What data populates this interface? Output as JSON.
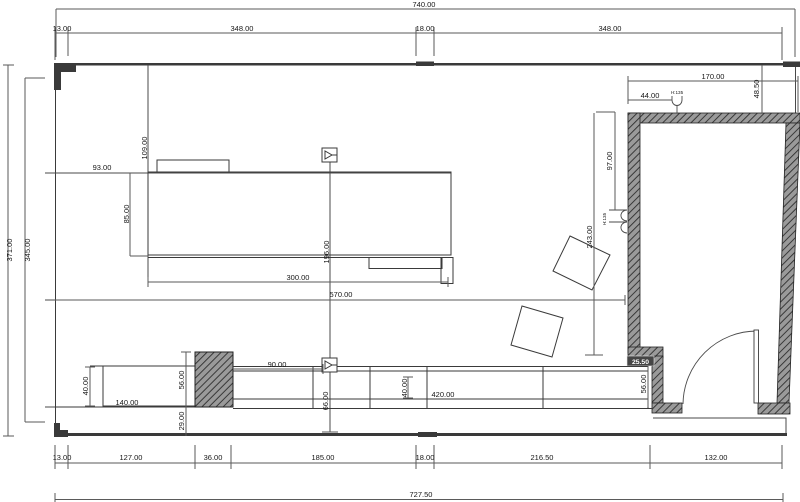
{
  "drawing": {
    "type": "architectural-floor-plan",
    "units_hint": "centimeters",
    "dims": {
      "top_total": "740.00",
      "top_13": "13.00",
      "top_348a": "348.00",
      "top_18": "18.00",
      "top_348b": "348.00",
      "left_total": "371.00",
      "left_inner": "345.00",
      "v109": "109.00",
      "h93": "93.00",
      "v85": "85.00",
      "h300": "300.00",
      "v196": "196.00",
      "h570": "570.00",
      "room_170": "170.00",
      "room_4850": "48.50",
      "room_44": "44.00",
      "h135_top": "H:135",
      "h135_side": "H:135",
      "v97": "97.00",
      "v243": "243.00",
      "wall_2550": "25.50",
      "v56_room": "56.00",
      "v40_left": "40.00",
      "h140": "140.00",
      "v56_col": "56.00",
      "v29": "29.00",
      "h90": "90.00",
      "v66": "66.00",
      "v40_mid": "40.00",
      "h420": "420.00",
      "bot_13": "13.00",
      "bot_127": "127.00",
      "bot_36": "36.00",
      "bot_185": "185.00",
      "bot_18": "18.00",
      "bot_21650": "216.50",
      "bot_132": "132.00",
      "bot_total": "727.50"
    }
  }
}
